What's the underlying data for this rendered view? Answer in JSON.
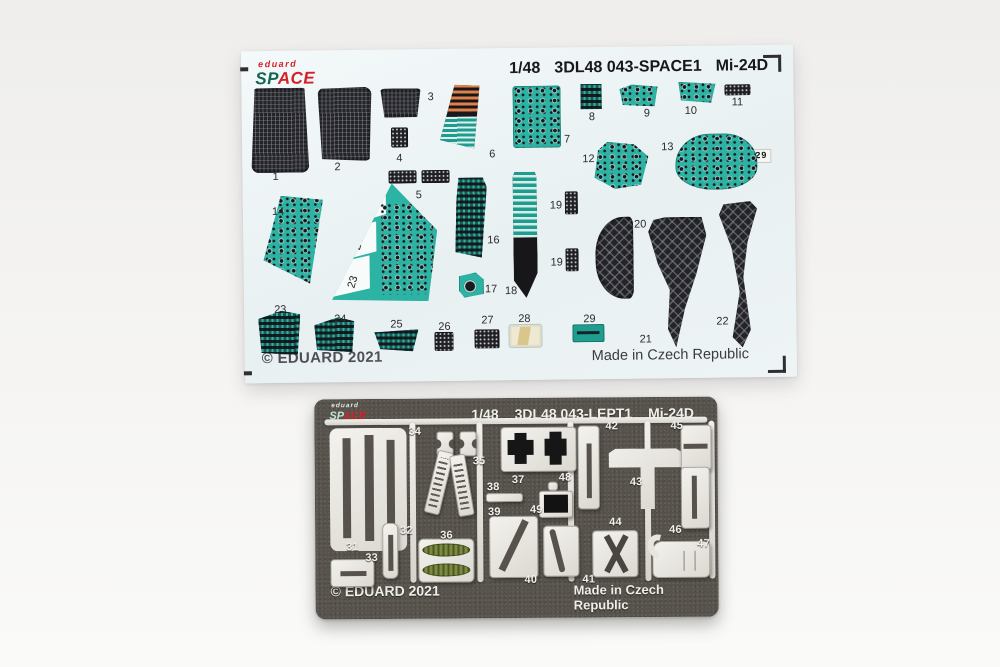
{
  "decal_sheet": {
    "logo_brand": "eduard",
    "logo_sp": "SP",
    "logo_ace": "ACE",
    "scale": "1/48",
    "code": "3DL48 043-SPACE1",
    "aircraft": "Mi-24D",
    "copyright": "© EDUARD 2021",
    "origin": "Made in Czech Republic",
    "panel13_label": "28 7 29",
    "wing_number": "15",
    "wing_sections": [
      "25",
      "24",
      "23"
    ],
    "parts": [
      {
        "n": "1",
        "x": 9,
        "y": 37,
        "w": 58,
        "h": 85,
        "cls": "mesh rib",
        "clip": "polygon(7% 0,93% 0,100% 100%,0 100%)",
        "r": "8px",
        "lx": 30,
        "ly": 120
      },
      {
        "n": "2",
        "x": 76,
        "y": 37,
        "w": 54,
        "h": 74,
        "cls": "mesh rib",
        "clip": "polygon(0 2%,100% 0,95% 100%,7% 97%)",
        "r": "8px",
        "lx": 92,
        "ly": 111
      },
      {
        "n": "3",
        "x": 138,
        "y": 39,
        "w": 42,
        "h": 29,
        "cls": "mesh rib",
        "clip": "polygon(2% 0,98% 0,89% 100%,11% 100%)",
        "r": "5px",
        "lx": 186,
        "ly": 42
      },
      {
        "n": "4",
        "x": 149,
        "y": 78,
        "w": 17,
        "h": 20,
        "cls": "darkp",
        "lx": 154,
        "ly": 103
      },
      {
        "n": "5",
        "x": 146,
        "y": 121,
        "w": 28,
        "h": 13,
        "cls": "darkp",
        "lx": 173,
        "ly": 140
      },
      {
        "x": 179,
        "y": 121,
        "w": 28,
        "h": 13,
        "cls": "darkp"
      },
      {
        "n": "6",
        "x": 198,
        "y": 36,
        "w": 40,
        "h": 64,
        "cls": "wedge6",
        "lx": 247,
        "ly": 100
      },
      {
        "n": "7",
        "x": 271,
        "y": 38,
        "w": 48,
        "h": 62,
        "cls": "instr",
        "r": "3px",
        "lx": 322,
        "ly": 86
      },
      {
        "n": "8",
        "x": 339,
        "y": 37,
        "w": 21,
        "h": 25,
        "cls": "instr-dark",
        "lx": 347,
        "ly": 64
      },
      {
        "n": "9",
        "x": 378,
        "y": 38,
        "w": 38,
        "h": 22,
        "cls": "instr",
        "clip": "polygon(0 20%,32% 0,100% 10%,92% 100%,8% 92%)",
        "lx": 402,
        "ly": 61
      },
      {
        "n": "10",
        "x": 437,
        "y": 36,
        "w": 37,
        "h": 21,
        "cls": "instr",
        "clip": "polygon(0 0,100% 10%,88% 100%,6% 88%)",
        "lx": 443,
        "ly": 59
      },
      {
        "n": "11",
        "x": 483,
        "y": 39,
        "w": 26,
        "h": 11,
        "cls": "darkp",
        "lx": 490,
        "ly": 51
      },
      {
        "n": "12",
        "x": 352,
        "y": 95,
        "w": 54,
        "h": 47,
        "cls": "instr",
        "clip": "polygon(24% 0,74% 6%,100% 32%,86% 92%,38% 100%,0 76%,7% 18%)",
        "lx": 340,
        "ly": 106
      },
      {
        "n": "13",
        "x": 433,
        "y": 88,
        "w": 82,
        "h": 56,
        "cls": "instr",
        "r": "42% 40% 46% 46% / 55% 52% 40% 40%",
        "lx": 419,
        "ly": 95
      },
      {
        "n": "14",
        "x": 20,
        "y": 145,
        "w": 60,
        "h": 88,
        "cls": "instr",
        "clip": "polygon(30% 0,100% 5%,77% 100%,0 73%)",
        "lx": 29,
        "ly": 155
      },
      {
        "n": "16",
        "x": 212,
        "y": 129,
        "w": 32,
        "h": 80,
        "cls": "instr-dark",
        "clip": "polygon(12% 0,88% 0,100% 12%,82% 100%,0 93%,5% 28%)",
        "lx": 244,
        "ly": 186
      },
      {
        "n": "17",
        "x": 215,
        "y": 224,
        "w": 25,
        "h": 25,
        "cls": "gauge1",
        "clip": "polygon(0 14%,68% 0,100% 28%,100% 86%,22% 100%,0 72%)",
        "lx": 241,
        "ly": 235
      },
      {
        "n": "18",
        "x": 270,
        "y": 124,
        "w": 24,
        "h": 126,
        "cls": "blade18",
        "lx": 261,
        "ly": 237
      },
      {
        "n": "19",
        "x": 322,
        "y": 144,
        "w": 13,
        "h": 23,
        "cls": "darkp",
        "lx": 307,
        "ly": 152
      },
      {
        "n": "19",
        "x": 322,
        "y": 201,
        "w": 13,
        "h": 23,
        "cls": "darkp",
        "lx": 307,
        "ly": 209
      },
      {
        "n": "20",
        "x": 352,
        "y": 170,
        "w": 38,
        "h": 82,
        "cls": "mesh big",
        "r": "75% 12% 14% 75% / 45% 10% 12% 45%",
        "lx": 391,
        "ly": 172
      },
      {
        "n": "21",
        "x": 405,
        "y": 171,
        "w": 58,
        "h": 130,
        "cls": "mesh big",
        "clip": "polygon(30% 0,92% 0,100% 14%,82% 44%,62% 70%,46% 100%,32% 86%,36% 56%,16% 36%,0 11%,9% 2%)",
        "lx": 395,
        "ly": 287
      },
      {
        "n": "22",
        "x": 476,
        "y": 156,
        "w": 38,
        "h": 146,
        "cls": "mesh big",
        "clip": "polygon(12% 2%,82% 0,100% 5%,74% 28%,62% 52%,80% 88%,58% 100%,32% 93%,52% 62%,32% 32%,0 9%)",
        "lx": 472,
        "ly": 270
      },
      {
        "n": "23",
        "x": 14,
        "y": 260,
        "w": 42,
        "h": 44,
        "cls": "instr-dark",
        "clip": "polygon(0 18%,55% 0,100% 8%,93% 100%,7% 95%)",
        "lx": 30,
        "ly": 253
      },
      {
        "n": "24",
        "x": 70,
        "y": 267,
        "w": 40,
        "h": 35,
        "cls": "instr-dark",
        "clip": "polygon(0 22%,60% 0,100% 12%,94% 100%,6% 93%)",
        "lx": 90,
        "ly": 263
      },
      {
        "n": "25",
        "x": 130,
        "y": 280,
        "w": 44,
        "h": 22,
        "cls": "instr-dark",
        "clip": "polygon(0 12%,100% 0,87% 100%,13% 88%)",
        "lx": 146,
        "ly": 269
      },
      {
        "n": "26",
        "x": 190,
        "y": 283,
        "w": 19,
        "h": 19,
        "cls": "darkp",
        "lx": 194,
        "ly": 272
      },
      {
        "n": "27",
        "x": 230,
        "y": 281,
        "w": 25,
        "h": 19,
        "cls": "darkp",
        "lx": 237,
        "ly": 266
      },
      {
        "n": "28",
        "x": 265,
        "y": 277,
        "w": 32,
        "h": 22,
        "cls": "placard28",
        "lx": 274,
        "ly": 265
      },
      {
        "n": "29",
        "x": 328,
        "y": 277,
        "w": 32,
        "h": 18,
        "cls": "placard29",
        "lx": 339,
        "ly": 266
      }
    ]
  },
  "etch_sheet": {
    "logo_brand": "eduard",
    "logo_sp": "SP",
    "logo_ace": "ACE",
    "scale": "1/48",
    "code": "3DL48 043-LEPT1",
    "aircraft": "Mi-24D",
    "copyright": "© EDUARD 2021",
    "origin": "Made in Czech Republic",
    "parts": [
      {
        "x": 10,
        "y": 20,
        "w": 383,
        "h": 6,
        "cls": "rail"
      },
      {
        "x": 95,
        "y": 24,
        "w": 6,
        "h": 160,
        "cls": "rail"
      },
      {
        "x": 162,
        "y": 24,
        "w": 6,
        "h": 160,
        "cls": "rail"
      },
      {
        "x": 253,
        "y": 24,
        "w": 6,
        "h": 160,
        "cls": "rail"
      },
      {
        "x": 330,
        "y": 24,
        "w": 6,
        "h": 160,
        "cls": "rail"
      },
      {
        "x": 394,
        "y": 24,
        "w": 6,
        "h": 158,
        "cls": "rail"
      },
      {
        "n": "31",
        "x": 15,
        "y": 29,
        "w": 77,
        "h": 123,
        "cls": "plate31",
        "r": "8px",
        "lx": 31,
        "ly": 142
      },
      {
        "n": "33",
        "x": 15,
        "y": 160,
        "w": 44,
        "h": 28,
        "cls": "silver sloth",
        "r": "4px",
        "lx": 50,
        "ly": 153
      },
      {
        "n": "32",
        "x": 67,
        "y": 124,
        "w": 16,
        "h": 56,
        "cls": "silver slot",
        "r": "6px",
        "lx": 85,
        "ly": 126
      },
      {
        "n": "34",
        "x": 122,
        "y": 33,
        "w": 17,
        "h": 25,
        "cls": "silver hpiece",
        "lx": 94,
        "ly": 27
      },
      {
        "x": 145,
        "y": 33,
        "w": 17,
        "h": 25,
        "cls": "silver hpiece"
      },
      {
        "n": "35",
        "x": 116,
        "y": 52,
        "w": 16,
        "h": 64,
        "cls": "silver buckle",
        "rot": 14,
        "lx": 158,
        "ly": 57
      },
      {
        "x": 139,
        "y": 56,
        "w": 16,
        "h": 62,
        "cls": "silver buckle",
        "rot": -9
      },
      {
        "n": "36",
        "x": 103,
        "y": 140,
        "w": 56,
        "h": 44,
        "cls": "silver plate36",
        "r": "5px",
        "lx": 125,
        "ly": 131
      },
      {
        "n": "37",
        "x": 186,
        "y": 29,
        "w": 76,
        "h": 45,
        "cls": "silver plate37",
        "r": "4px",
        "lx": 197,
        "ly": 76
      },
      {
        "n": "38",
        "x": 171,
        "y": 95,
        "w": 37,
        "h": 9,
        "cls": "silver",
        "lx": 172,
        "ly": 83
      },
      {
        "n": "39",
        "x": 174,
        "y": 118,
        "w": 49,
        "h": 62,
        "cls": "silver plate39",
        "r": "4px",
        "lx": 173,
        "ly": 108
      },
      {
        "n": "40",
        "lx": 209,
        "ly": 176
      },
      {
        "n": "41",
        "x": 228,
        "y": 128,
        "w": 36,
        "h": 51,
        "cls": "silver plate41",
        "r": "4px",
        "lx": 267,
        "ly": 176
      },
      {
        "n": "48",
        "x": 233,
        "y": 84,
        "w": 10,
        "h": 9,
        "cls": "silver",
        "lx": 244,
        "ly": 74
      },
      {
        "n": "49",
        "x": 224,
        "y": 93,
        "w": 34,
        "h": 27,
        "cls": "silver plate49",
        "r": "3px",
        "lx": 215,
        "ly": 106
      },
      {
        "n": "42",
        "x": 263,
        "y": 28,
        "w": 22,
        "h": 84,
        "cls": "silver slot",
        "r": "4px",
        "lx": 291,
        "ly": 23
      },
      {
        "n": "43",
        "x": 294,
        "y": 40,
        "w": 74,
        "h": 72,
        "cls": "cross43",
        "lx": 315,
        "ly": 79
      },
      {
        "n": "44",
        "x": 277,
        "y": 133,
        "w": 46,
        "h": 47,
        "cls": "silver plate44",
        "r": "4px",
        "lx": 294,
        "ly": 119
      },
      {
        "n": "45",
        "x": 366,
        "y": 28,
        "w": 31,
        "h": 46,
        "cls": "silver blade",
        "r": "4px",
        "lx": 356,
        "ly": 23
      },
      {
        "n": "46",
        "x": 366,
        "y": 70,
        "w": 29,
        "h": 62,
        "cls": "silver blade2",
        "r": "4px",
        "lx": 354,
        "ly": 127
      },
      {
        "n": "47",
        "x": 337,
        "y": 144,
        "w": 58,
        "h": 37,
        "cls": "silver seat47",
        "lx": 382,
        "ly": 141
      }
    ]
  },
  "colors": {
    "teal_panel": "#2db3a4",
    "decal_sheet_bg": "#e8f0f2",
    "etch_sheet_bg": "#57534c",
    "part_black": "#232328",
    "stripe_orange": "#e0814b",
    "pedal_green": "#7d8b42",
    "logo_red": "#d42027",
    "logo_green": "#136653",
    "etch_silver": "#e9e7e3"
  }
}
